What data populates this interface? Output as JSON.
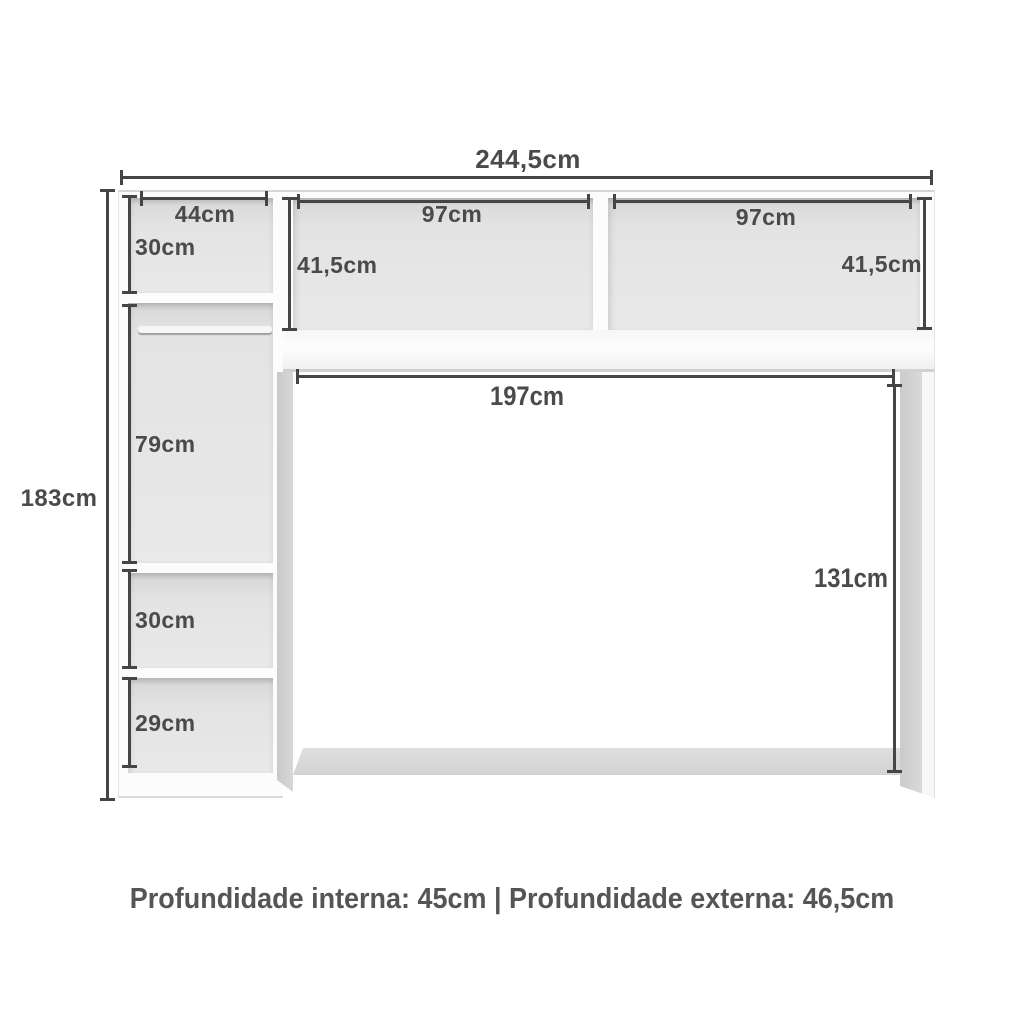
{
  "dims": {
    "overall_width": "244,5cm",
    "overall_height": "183cm",
    "top_left_shelf_width": "44cm",
    "top_left_shelf_height": "30cm",
    "hutch_left_width": "97cm",
    "hutch_left_height": "41,5cm",
    "hutch_right_width": "97cm",
    "hutch_right_height": "41,5cm",
    "hanging_compartment_height": "79cm",
    "middle_shelf_height": "30cm",
    "bottom_shelf_height": "29cm",
    "opening_width": "197cm",
    "opening_height": "131cm"
  },
  "footer": {
    "depth_note": "Profundidade interna: 45cm | Profundidade externa: 46,5cm"
  },
  "colors": {
    "dimension_line": "#454545",
    "label_text": "#4a4a4a",
    "compartment_interior": "#e3e3e3",
    "frame": "#fcfcfc",
    "background": "#ffffff"
  }
}
